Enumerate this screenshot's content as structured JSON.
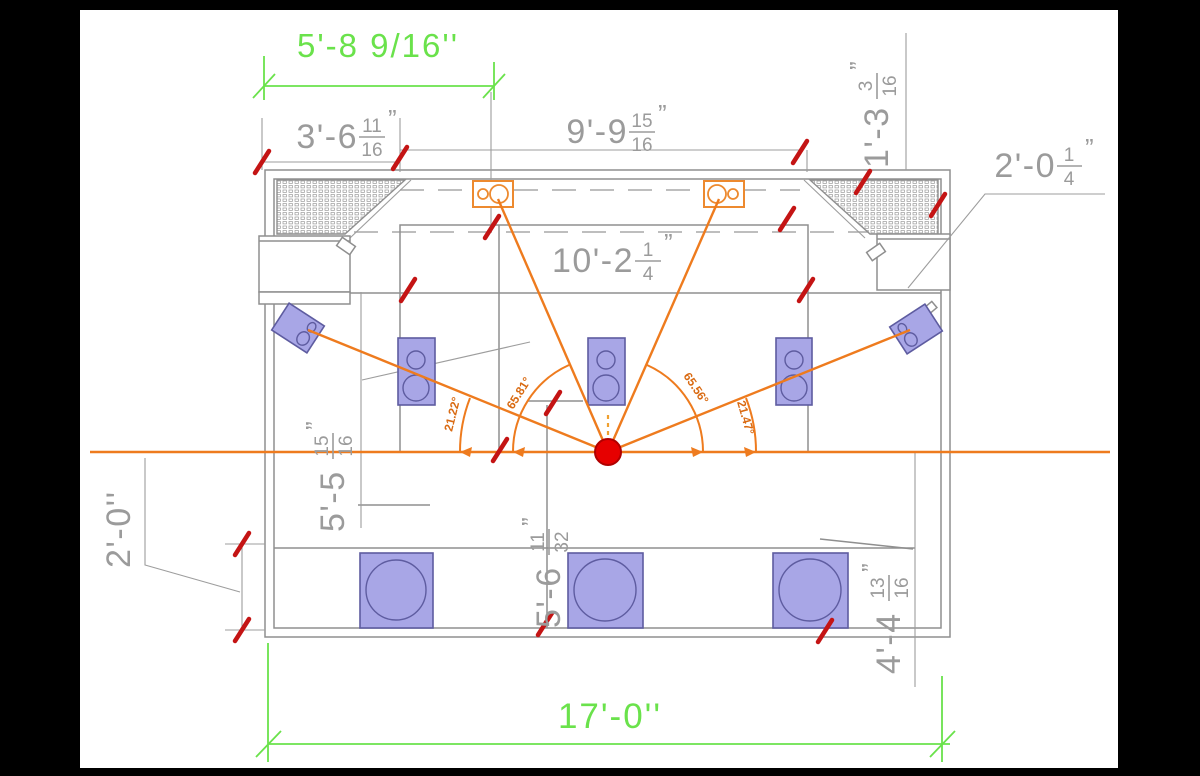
{
  "drawing": {
    "type": "room-plan-speaker-layout",
    "dimensions": {
      "offset_front_green": "5'-8 9/16''",
      "front_left": {
        "whole": "3'-6",
        "num": "11",
        "den": "16",
        "unit": "”"
      },
      "front_center": {
        "whole": "9'-9",
        "num": "15",
        "den": "16",
        "unit": "”"
      },
      "front_right": {
        "whole": "1'-3",
        "num": "3",
        "den": "16",
        "unit": "”"
      },
      "cabinet_depth": {
        "whole": "2'-0",
        "num": "1",
        "den": "4",
        "unit": "”"
      },
      "stage_width": {
        "whole": "10'-2",
        "num": "1",
        "den": "4",
        "unit": "”"
      },
      "left_listening": {
        "whole": "5'-5",
        "num": "15",
        "den": "16",
        "unit": "”"
      },
      "left_step": "2'-0''",
      "center_listening": {
        "whole": "5'-6",
        "num": "11",
        "den": "32",
        "unit": "”"
      },
      "right_rear": {
        "whole": "4'-4",
        "num": "13",
        "den": "16",
        "unit": "”"
      },
      "room_width_green": "17'-0''"
    },
    "angles": {
      "left_surround": "21.22°",
      "left_front": "65.81°",
      "right_front": "65.56°",
      "right_surround": "21.47°"
    },
    "colors": {
      "dimension_green": "#6ae24b",
      "line_orange": "#ee7b1e",
      "tick_red": "#c41414",
      "listener_red": "#e60000",
      "speaker_purple": "#a8a6e6",
      "drawing_gray": "#8f8f8f"
    }
  }
}
